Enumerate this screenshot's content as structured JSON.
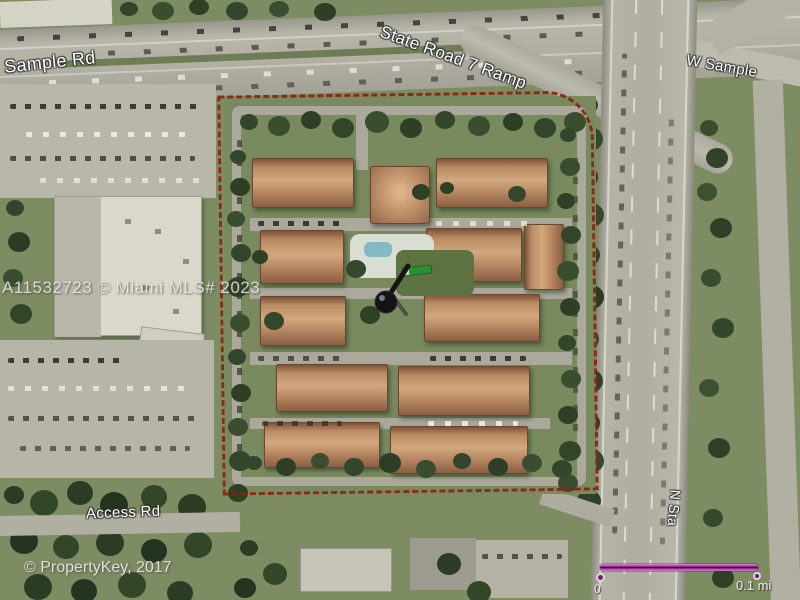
{
  "map": {
    "road_labels": {
      "sample_rd": "Sample Rd",
      "state_road_7_ramp": "State Road 7 Ramp",
      "w_sample": "W Sample",
      "access_rd": "Access Rd",
      "n_state_road": "N Sta"
    },
    "watermarks": {
      "listing": "A11532723 © Miami MLS# 2023",
      "provider": "© PropertyKey, 2017"
    },
    "scale_bar": {
      "start": "0",
      "end": "0.1 mi",
      "bar_color": "#b040a8"
    },
    "icons": {
      "property_marker": "pushpin-icon",
      "secondary_marker": "green-arrow-icon"
    },
    "boundary": {
      "color": "#8d2513",
      "style": "dashed"
    }
  }
}
